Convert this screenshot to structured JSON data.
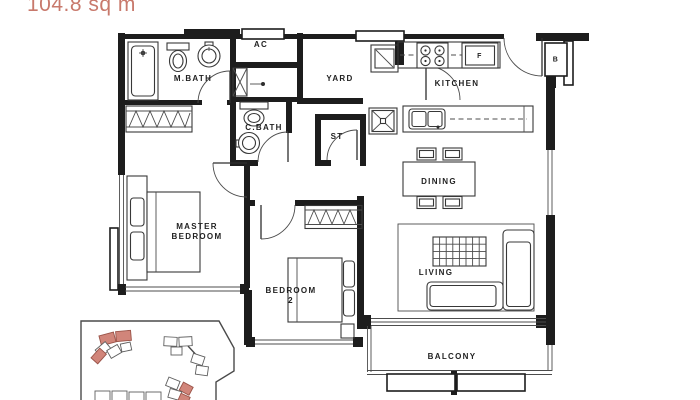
{
  "colors": {
    "accent": "#c8796c",
    "wall": "#1d1d1d",
    "site_highlight": "#d1857a"
  },
  "labels": {
    "area": "104.8 sq m",
    "mbath": "M.BATH",
    "ac": "AC",
    "yard": "YARD",
    "kitchen": "KITCHEN",
    "cbath": "C.BATH",
    "st": "ST",
    "dining": "DINING",
    "master_line1": "MASTER",
    "master_line2": "BEDROOM",
    "bedroom2_line1": "BEDROOM",
    "bedroom2_line2": "2",
    "living": "LIVING",
    "balcony": "BALCONY",
    "fridge": "F",
    "shelter": "B"
  }
}
